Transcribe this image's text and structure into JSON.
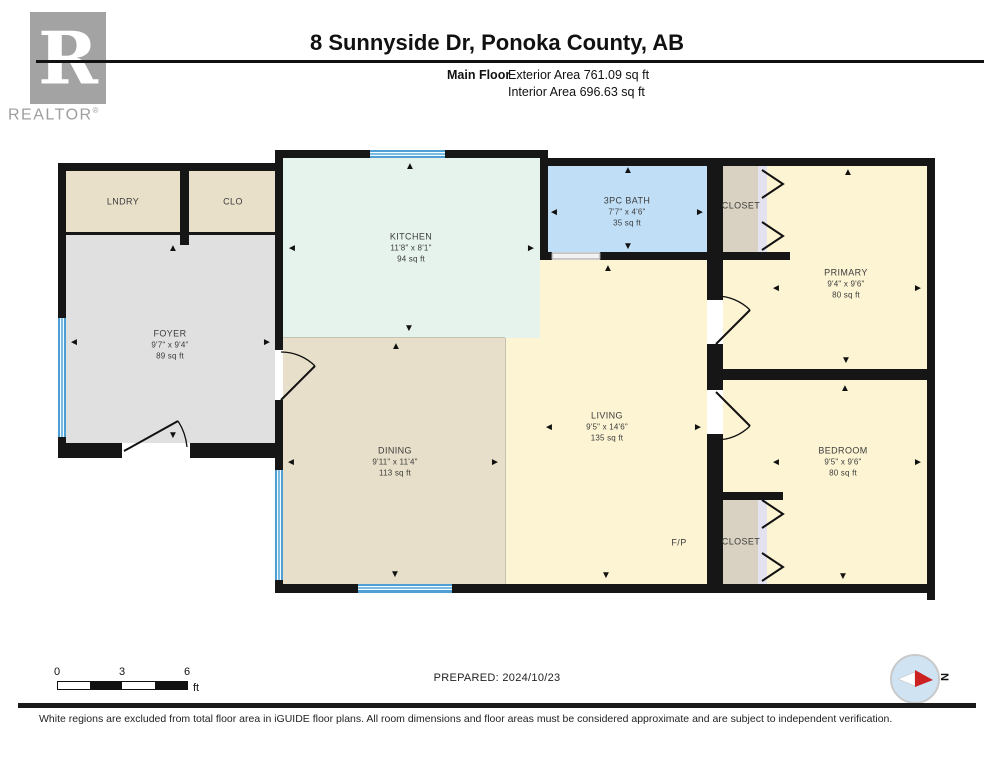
{
  "header": {
    "logo_letter": "R",
    "logo_brand": "REALTOR",
    "logo_registered": "®",
    "title": "8 Sunnyside Dr, Ponoka County, AB",
    "floor_label": "Main Floor",
    "exterior_area": "Exterior Area 761.09 sq ft",
    "interior_area": "Interior Area 696.63 sq ft"
  },
  "rooms": {
    "lndry": {
      "name": "LNDRY"
    },
    "clo": {
      "name": "CLO"
    },
    "foyer": {
      "name": "FOYER",
      "dims": "9'7\" x 9'4\"",
      "area": "89 sq ft"
    },
    "kitchen": {
      "name": "KITCHEN",
      "dims": "11'8\" x 8'1\"",
      "area": "94 sq ft"
    },
    "bath": {
      "name": "3PC BATH",
      "dims": "7'7\" x 4'6\"",
      "area": "35 sq ft"
    },
    "dining": {
      "name": "DINING",
      "dims": "9'11\" x 11'4\"",
      "area": "113 sq ft"
    },
    "living": {
      "name": "LIVING",
      "dims": "9'5\" x 14'6\"",
      "area": "135 sq ft"
    },
    "primary": {
      "name": "PRIMARY",
      "dims": "9'4\" x 9'6\"",
      "area": "80 sq ft"
    },
    "bedroom": {
      "name": "BEDROOM",
      "dims": "9'5\" x 9'6\"",
      "area": "80 sq ft"
    },
    "closet_top": {
      "name": "CLOSET"
    },
    "closet_bottom": {
      "name": "CLOSET"
    },
    "fireplace": {
      "name": "F/P"
    }
  },
  "scale_bar": {
    "tick0": "0",
    "tick3": "3",
    "tick6": "6",
    "unit": "ft"
  },
  "prepared": "PREPARED: 2024/10/23",
  "compass": {
    "north": "N"
  },
  "footer_disclaimer": "White regions are excluded from total floor area in iGUIDE floor plans. All room dimensions and floor areas must be considered approximate and are subject to independent verification.",
  "colors": {
    "wall": "#161616",
    "laundry_beige": "#e9e0c9",
    "foyer_gray": "#e0e0e0",
    "kitchen_mint": "#e6f2ec",
    "bath_blue": "#c0dff7",
    "cream": "#fcf4d3",
    "dining_tan": "#e7dfc9",
    "closet_tan": "#d9d2c2",
    "window_blue": "#4f9fd4",
    "compass_red": "#cc2222"
  }
}
